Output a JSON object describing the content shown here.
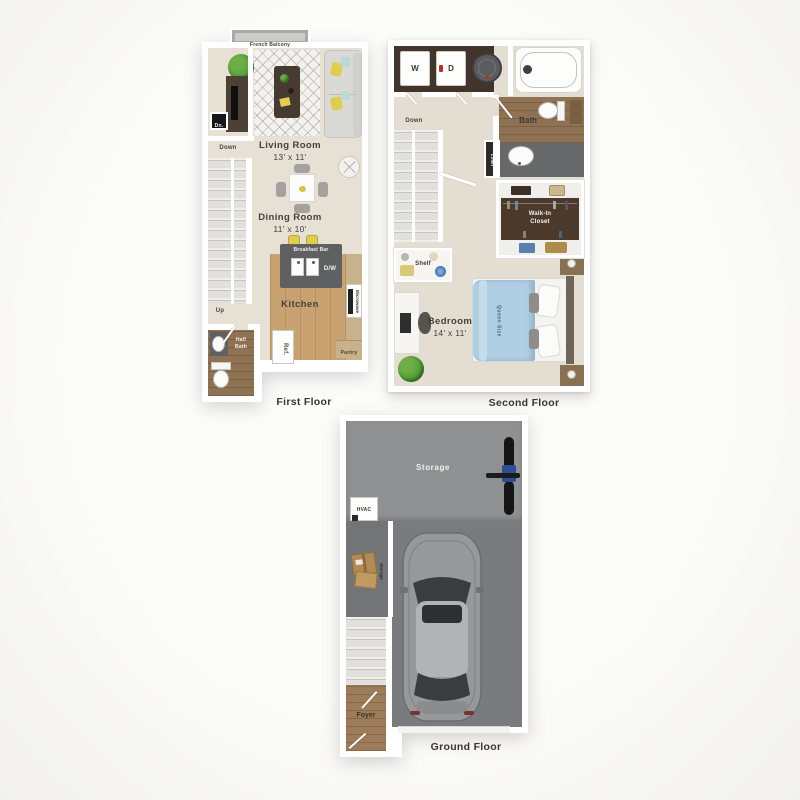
{
  "floors": {
    "first": {
      "caption": "First Floor",
      "balcony_label": "French Balcony",
      "closet_label": "Dn.",
      "stairs_down_label": "Down",
      "stairs_up_label": "Up",
      "living_room": {
        "name": "Living Room",
        "dims": "13' x 11'"
      },
      "dining_room": {
        "name": "Dining Room",
        "dims": "11' x 10'"
      },
      "breakfast_bar_label": "Breakfast Bar",
      "dishwasher_label": "D/W",
      "kitchen_label": "Kitchen",
      "microwave_label": "Microwave",
      "refrigerator_label": "Ref.",
      "pantry_label": "Pantry",
      "half_bath_label": "Half Bath"
    },
    "second": {
      "caption": "Second Floor",
      "washer_label": "W",
      "dryer_label": "D",
      "bath_label": "Bath",
      "stairs_down_label": "Down",
      "linen_label": "Linen",
      "walk_in_closet_label": "Walk-In Closet",
      "shelf_label": "Shelf",
      "bedroom": {
        "name": "Bedroom",
        "dims": "14' x 11'"
      },
      "bed_label": "Queen Size"
    },
    "ground": {
      "caption": "Ground Floor",
      "storage_label": "Storage",
      "hvac_label": "HVAC",
      "storage_boxes_label": "Storage",
      "foyer_label": "Foyer"
    }
  },
  "palette": {
    "floor_beige": "#e6e0d5",
    "kitchen_wood": "#c9a272",
    "bath_wood": "#8f7154",
    "counter_gray": "#5f6062",
    "closet_brown": "#4b392b",
    "tile_gray": "#66686a",
    "storage_gray": "#8f9092",
    "garage_gray": "#7a7b7e",
    "bed_blue": "#b0cfe3",
    "accent_yellow": "#dfcd50",
    "plant_green": "#57a03b"
  }
}
